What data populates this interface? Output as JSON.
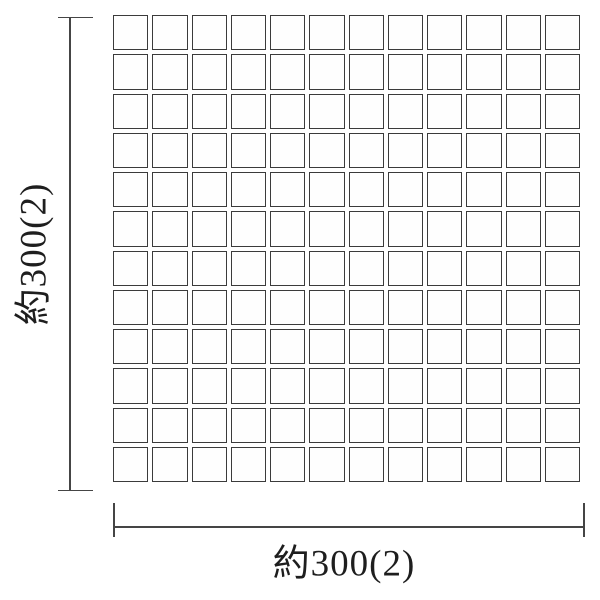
{
  "colors": {
    "background": "#ffffff",
    "line": "#454545",
    "tile_border": "#3b3b3b",
    "tile_fill": "#fefefe",
    "text": "#1e1e1e"
  },
  "grid": {
    "rows": 12,
    "cols": 12,
    "tile_count": 144
  },
  "dimensions": {
    "vertical": {
      "label": "約300(2)"
    },
    "horizontal": {
      "label": "約300(2)"
    }
  }
}
